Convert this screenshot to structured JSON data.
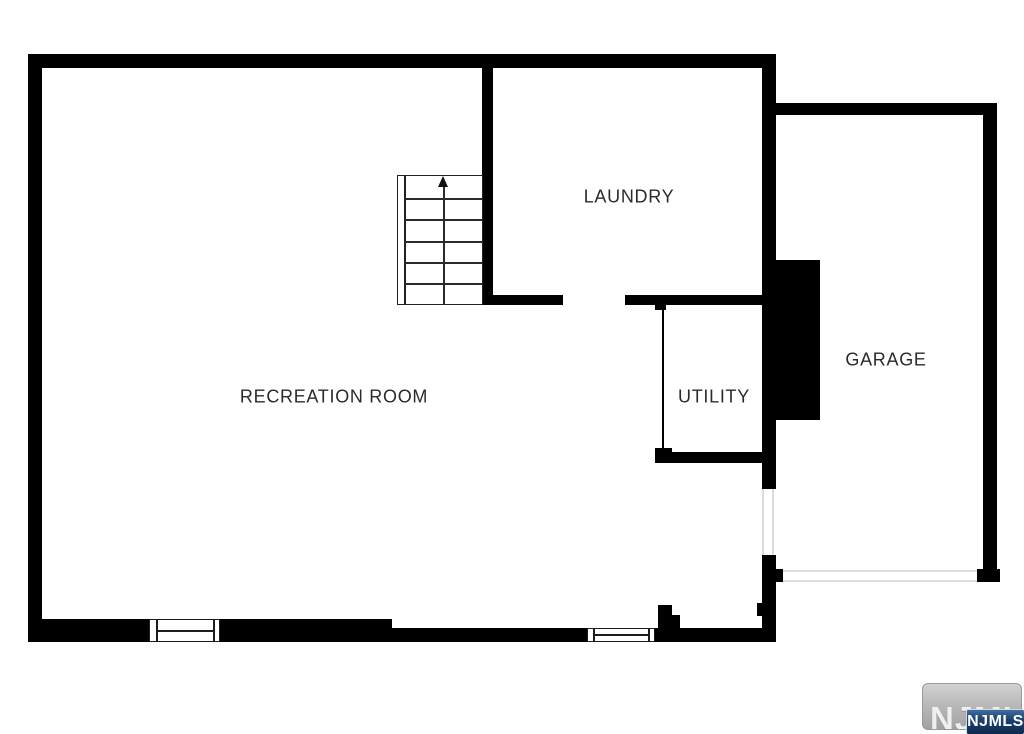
{
  "rooms": {
    "recreation": {
      "label": "RECREATION ROOM"
    },
    "laundry": {
      "label": "LAUNDRY"
    },
    "utility": {
      "label": "UTILITY"
    },
    "garage": {
      "label": "GARAGE"
    }
  },
  "watermark": {
    "logo_text": "NJMLS",
    "badge_text": "NJMLS"
  },
  "colors": {
    "wall": "#000000",
    "background": "#ffffff",
    "label_text": "#2b2b2b",
    "watermark_gray": "#b9b9b9",
    "badge_blue": "#1b4272"
  }
}
